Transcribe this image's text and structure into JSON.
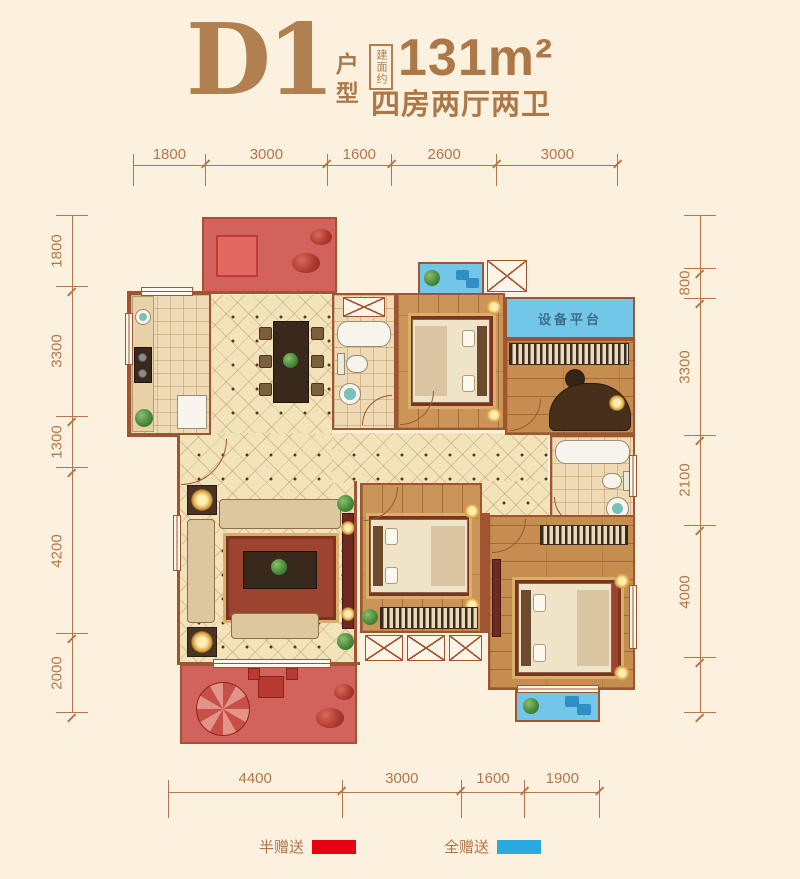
{
  "header": {
    "plan_code": "D1",
    "plan_type": "户型",
    "area_tag": "建面约",
    "area_value": "131m²",
    "layout_desc": "四房两厅两卫"
  },
  "rulers": {
    "top": [
      "1800",
      "3000",
      "1600",
      "2600",
      "3000"
    ],
    "bottom": [
      "4400",
      "3000",
      "1600",
      "1900"
    ],
    "left": [
      "1800",
      "3300",
      "1300",
      "4200",
      "2000"
    ],
    "right": [
      "",
      "800",
      "3300",
      "2100",
      "4000",
      ""
    ]
  },
  "plan": {
    "equipment_platform_label": "设备平台"
  },
  "legend": {
    "half_gift_label": "半赠送",
    "half_gift_color": "#e60012",
    "full_gift_label": "全赠送",
    "full_gift_color": "#29abe2"
  },
  "colors": {
    "background": "#fcf1de",
    "accent_brown": "#b08050",
    "dimension_line": "#b5764a",
    "wall": "#a05431",
    "floor_cream": "#f3e3ba",
    "floor_wood": "#cb9458",
    "half_gift_overlay": "#d2625c",
    "full_gift_area": "#72c6e8"
  }
}
